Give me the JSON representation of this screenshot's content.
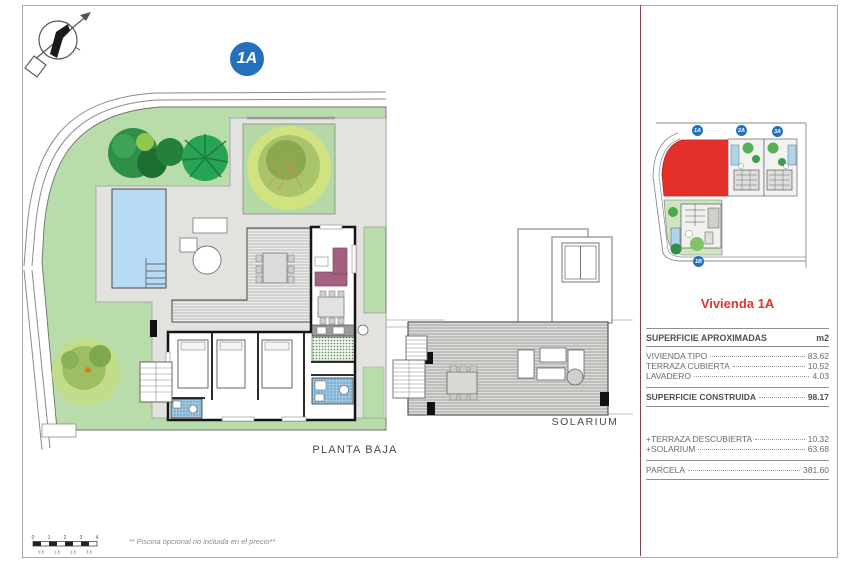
{
  "page": {
    "badge": "1A",
    "labels": {
      "planta_baja": "PLANTA BAJA",
      "solarium": "SOLARIUM"
    },
    "footnote": "** Piscina opcional no incluida en el precio**"
  },
  "scalebar": {
    "top": [
      "0",
      "1",
      "2",
      "3",
      "4"
    ],
    "bottom": [
      "0.5",
      "1.5",
      "2.5",
      "3.5"
    ]
  },
  "site_plan": {
    "badges": [
      "1A",
      "2A",
      "3A",
      "1B"
    ],
    "highlight_color": "#e5312b"
  },
  "panel": {
    "title": "Vivienda 1A",
    "title_color": "#e2342c",
    "table": {
      "header": {
        "label": "SUPERFICIE APROXIMADAS",
        "unit": "m2"
      },
      "rows": [
        {
          "label": "VIVIENDA TIPO",
          "value": "83.62"
        },
        {
          "label": "TERRAZA CUBIERTA",
          "value": "10.52"
        },
        {
          "label": "LAVADERO",
          "value": "4.03"
        }
      ],
      "total": {
        "label": "SUPERFICIE CONSTRUIDA",
        "value": "98.17"
      },
      "extras": [
        {
          "label": "+TERRAZA DESCUBIERTA",
          "value": "10.32"
        },
        {
          "label": "+SOLARIUM",
          "value": "63.68"
        }
      ],
      "parcel": {
        "label": "PARCELA",
        "value": "381.60"
      }
    }
  },
  "colors": {
    "badge_blue": "#2470bd",
    "garden_green": "#b8dcaa",
    "pool_blue": "#b6dbf2",
    "deck_gray": "#e2e2df",
    "divider": "#7d4848"
  }
}
